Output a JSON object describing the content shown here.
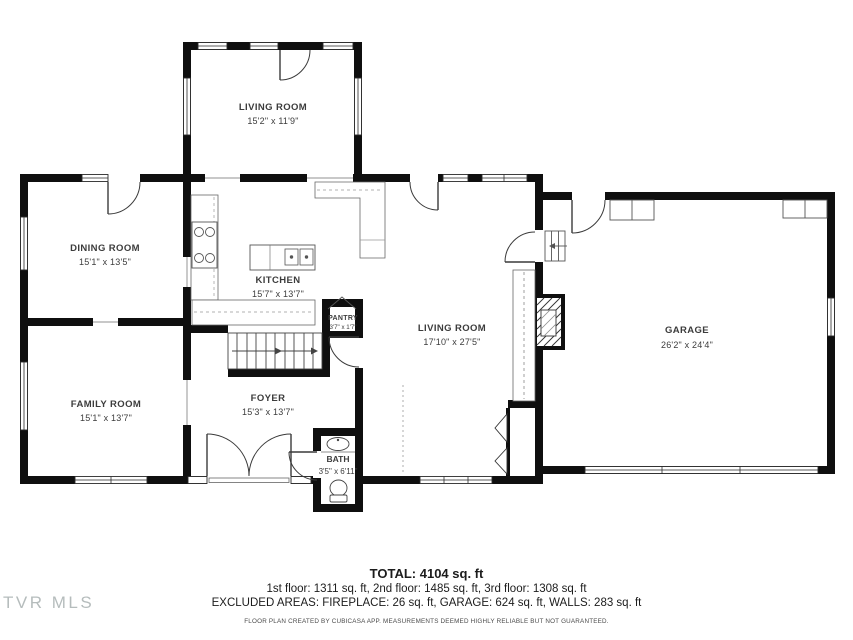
{
  "watermark": "TVR MLS",
  "rooms": {
    "living_top": {
      "name": "LIVING ROOM",
      "dims": "15'2\" x 11'9\""
    },
    "dining": {
      "name": "DINING ROOM",
      "dims": "15'1\" x 13'5\""
    },
    "kitchen": {
      "name": "KITCHEN",
      "dims": "15'7\" x 13'7\""
    },
    "pantry": {
      "name": "PANTRY",
      "dims": "3'7\" x 1'7\""
    },
    "living_main": {
      "name": "LIVING ROOM",
      "dims": "17'10\" x 27'5\""
    },
    "garage": {
      "name": "GARAGE",
      "dims": "26'2\" x 24'4\""
    },
    "family": {
      "name": "FAMILY ROOM",
      "dims": "15'1\" x 13'7\""
    },
    "foyer": {
      "name": "FOYER",
      "dims": "15'3\" x 13'7\""
    },
    "bath": {
      "name": "BATH",
      "dims": "3'5\" x 6'11\""
    }
  },
  "summary": {
    "total": "TOTAL: 4104 sq. ft",
    "floors": "1st floor: 1311 sq. ft, 2nd floor: 1485 sq. ft, 3rd floor: 1308 sq. ft",
    "excluded": "EXCLUDED AREAS: FIREPLACE: 26 sq. ft, GARAGE: 624 sq. ft, WALLS: 283 sq. ft"
  },
  "footer": "FLOOR PLAN CREATED BY CUBICASA APP. MEASUREMENTS DEEMED HIGHLY RELIABLE BUT NOT GUARANTEED.",
  "colors": {
    "walls": "#0f0f0f",
    "labels": "#3c3c3c",
    "watermark": "#b5bcbc"
  }
}
